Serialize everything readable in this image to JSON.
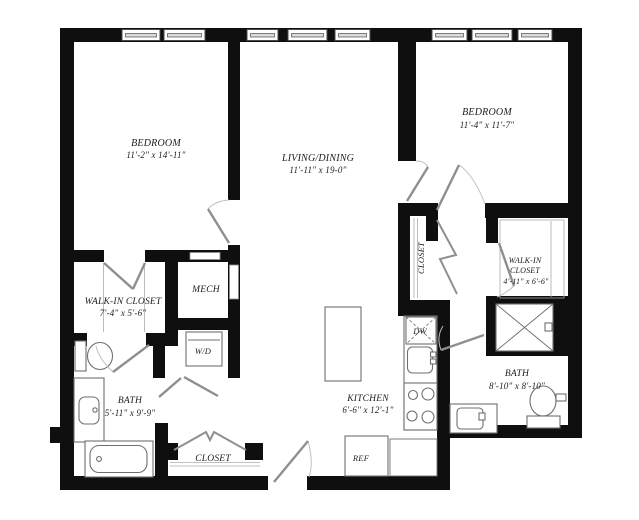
{
  "floorplan": {
    "colors": {
      "wall": "#0f0f0f",
      "door": "#8f8f8f",
      "door_arc": "#c0c0c0",
      "fixture": "#6f6f6f",
      "thin_line": "#ababab",
      "window_frame": "#4a4a4a",
      "window_bar": "#dcdcdc",
      "text": "#1c1c1c",
      "background": "#ffffff"
    },
    "rooms": {
      "bedroom1": {
        "name": "BEDROOM",
        "dims": "11'-2\" x 14'-11\""
      },
      "living": {
        "name": "LIVING/DINING",
        "dims": "11'-11\" x 19-0\""
      },
      "bedroom2": {
        "name": "BEDROOM",
        "dims": "11'-4\" x 11'-7\""
      },
      "wic1": {
        "name": "WALK-IN CLOSET",
        "dims": "7'-4\" x 5'-6\""
      },
      "mech": {
        "name": "MECH"
      },
      "laundry": {
        "name": "W/D"
      },
      "bath1": {
        "name": "BATH",
        "dims": "5'-11\" x 9'-9\""
      },
      "entry_closet": {
        "name": "CLOSET"
      },
      "kitchen": {
        "name": "KITCHEN",
        "dims": "6'-6\" x 12'-1\""
      },
      "fridge": {
        "name": "REF"
      },
      "dishwasher": {
        "name": "DW"
      },
      "hall_closet": {
        "name": "CLOSET"
      },
      "wic2": {
        "line1": "WALK-IN",
        "line2": "CLOSET",
        "dims": "4'-11\" x 6'-6\""
      },
      "bath2": {
        "name": "BATH",
        "dims": "8'-10\" x 8'-10\""
      }
    }
  }
}
